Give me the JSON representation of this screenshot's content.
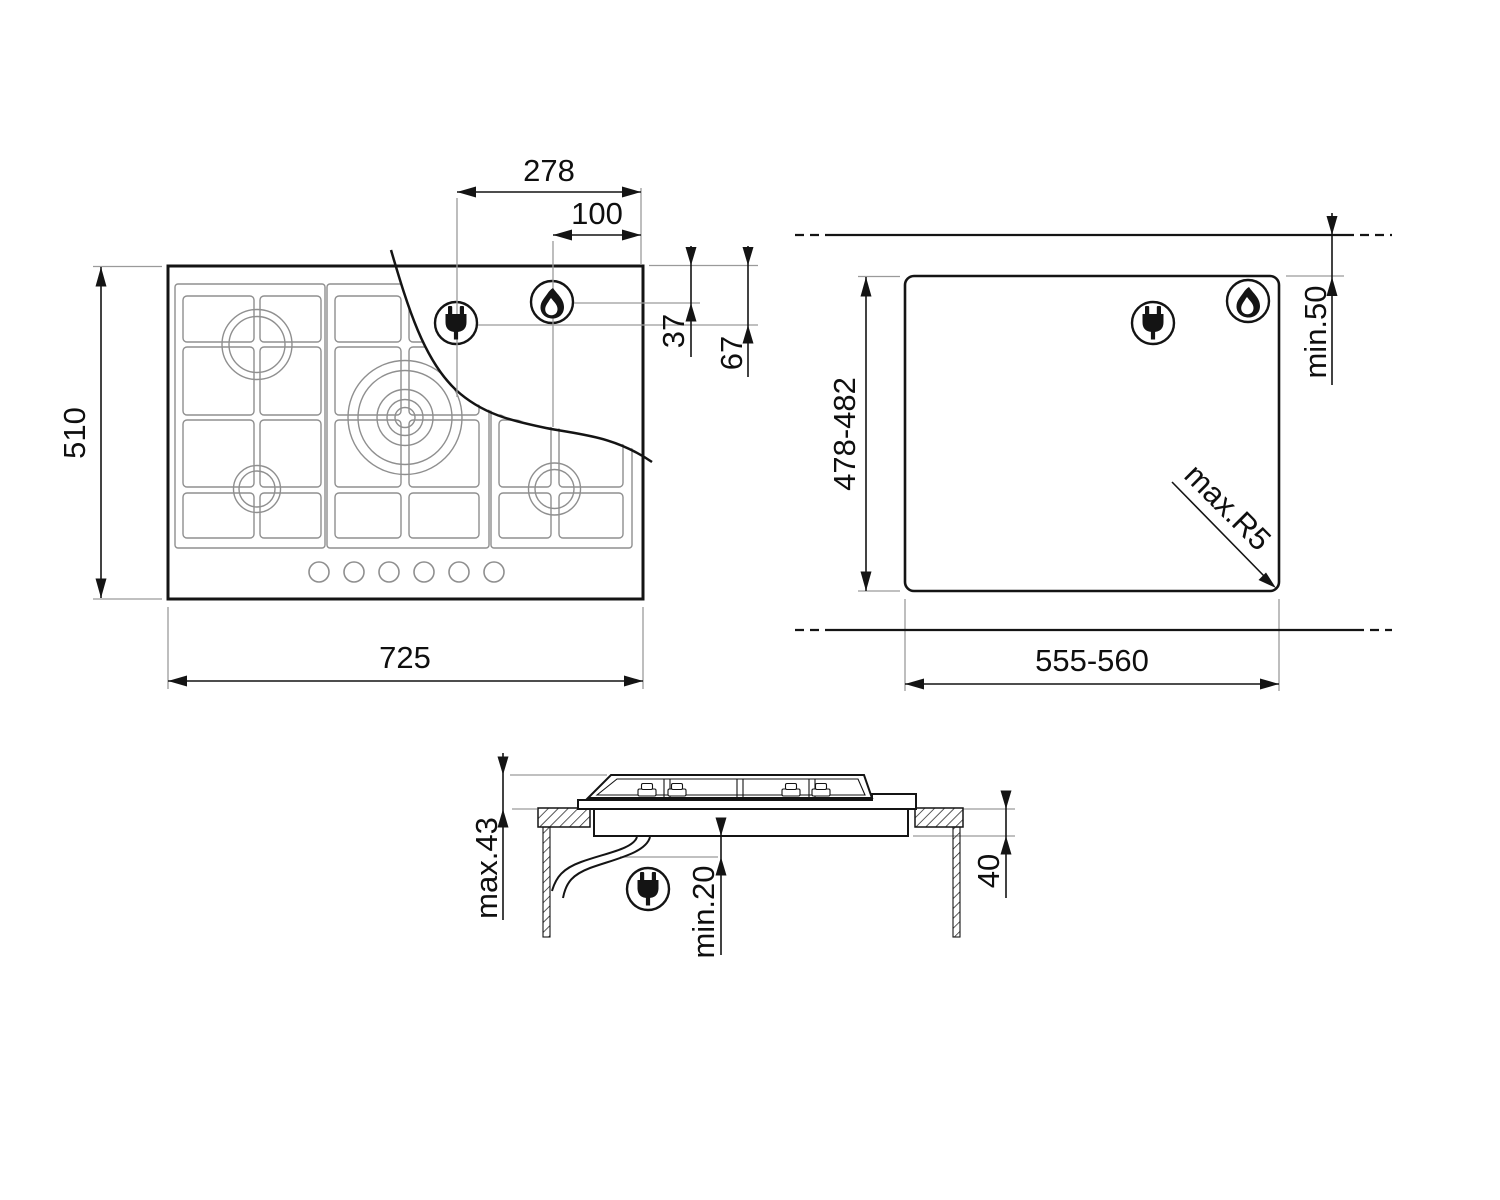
{
  "page": {
    "background": "#ffffff"
  },
  "colors": {
    "line": "#141414",
    "aux_line": "#9a9a9a",
    "grid_line": "#8f8f8f",
    "text": "#0f0f0f"
  },
  "icons": {
    "plug": "electric-plug",
    "flame": "gas-flame"
  },
  "plan_view": {
    "width_label": "725",
    "depth_label": "510",
    "plug_offset_label": "278",
    "flame_offset_label": "100",
    "flame_top_offset_label": "37",
    "plug_top_offset_label": "67"
  },
  "cutout_view": {
    "width_label": "555-560",
    "depth_label": "478-482",
    "wall_clearance_label": "min.50",
    "corner_radius_label": "max.R5"
  },
  "section_view": {
    "height_above_label": "max.43",
    "clearance_below_label": "min.20",
    "worktop_thickness_label": "40"
  }
}
